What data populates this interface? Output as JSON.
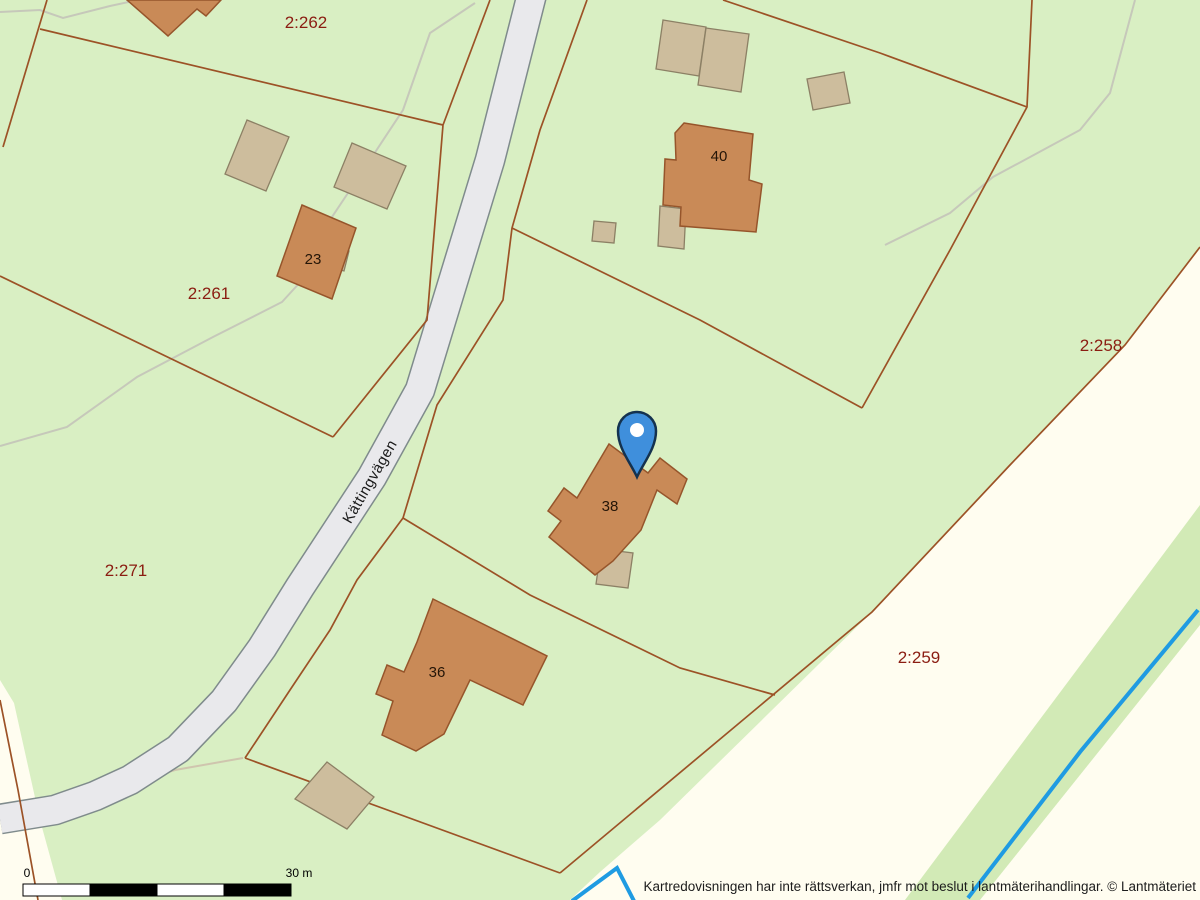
{
  "map": {
    "attribution": "Kartredovisningen har inte rättsverkan, jmfr mot beslut i lantmäterihandlingar. © Lantmäteriet",
    "road": {
      "name": "Kättingvägen"
    },
    "scale_bar": {
      "zero": "0",
      "max": "30 m"
    },
    "parcels": [
      {
        "label": "2:262"
      },
      {
        "label": "2:261"
      },
      {
        "label": "2:271"
      },
      {
        "label": "2:258"
      },
      {
        "label": "2:259"
      }
    ],
    "buildings": [
      {
        "number": "23"
      },
      {
        "number": "40"
      },
      {
        "number": "38"
      },
      {
        "number": "36"
      }
    ],
    "marker": {
      "type": "location-pin",
      "color": "#3f8fdc"
    },
    "colors": {
      "background_green": "#d9efc3",
      "open_land_cream": "#fffdf0",
      "road_fill": "#e9e9ec",
      "road_casing": "#7f8b8c",
      "building_main": "#c98a57",
      "building_main_stroke": "#96552b",
      "building_other": "#cdbd9d",
      "building_other_stroke": "#8c8065",
      "boundary_line": "#9c5226",
      "parcel_label_red": "#8b1d12",
      "stream_blue": "#1f9be2",
      "trail_gray": "#c6c8ba"
    }
  }
}
